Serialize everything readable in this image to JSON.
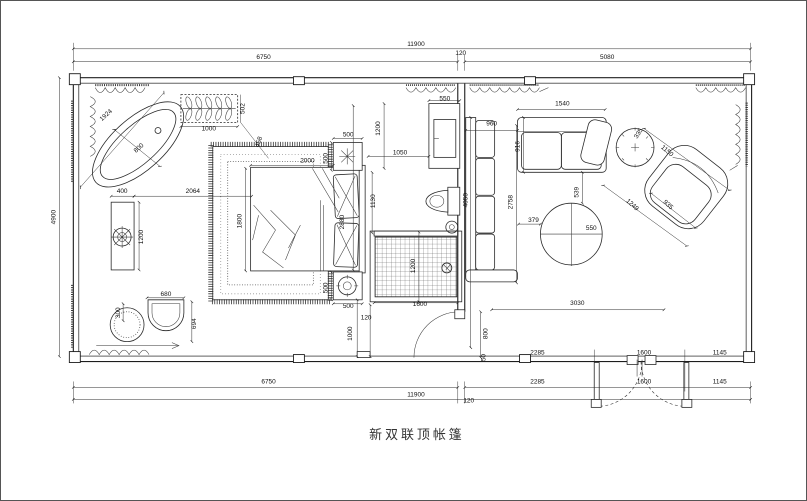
{
  "plan": {
    "title": "新双联顶帐篷",
    "overall": {
      "width_mm": "11900",
      "height_mm": "4900"
    },
    "dim_labels": [
      {
        "t": "11900",
        "x": 416,
        "y": 45
      },
      {
        "t": "6750",
        "x": 263,
        "y": 58
      },
      {
        "t": "120",
        "x": 461,
        "y": 54
      },
      {
        "t": "5080",
        "x": 608,
        "y": 58
      },
      {
        "t": "4900",
        "x": 54,
        "y": 217,
        "r": -90
      },
      {
        "t": "1924",
        "x": 106,
        "y": 116,
        "r": -42
      },
      {
        "t": "800",
        "x": 139,
        "y": 149,
        "r": -42
      },
      {
        "t": "1000",
        "x": 208,
        "y": 130
      },
      {
        "t": "502",
        "x": 244,
        "y": 108,
        "r": -90
      },
      {
        "t": "458",
        "x": 260,
        "y": 142,
        "r": -72
      },
      {
        "t": "400",
        "x": 121,
        "y": 193
      },
      {
        "t": "2064",
        "x": 192,
        "y": 193
      },
      {
        "t": "1200",
        "x": 142,
        "y": 237,
        "r": -90
      },
      {
        "t": "300",
        "x": 119,
        "y": 313,
        "r": -90
      },
      {
        "t": "680",
        "x": 165,
        "y": 296
      },
      {
        "t": "694",
        "x": 195,
        "y": 324,
        "r": -90
      },
      {
        "t": "2000",
        "x": 307,
        "y": 162
      },
      {
        "t": "1800",
        "x": 241,
        "y": 221,
        "r": -90
      },
      {
        "t": "500",
        "x": 348,
        "y": 136
      },
      {
        "t": "500",
        "x": 327,
        "y": 158,
        "r": -90
      },
      {
        "t": "500",
        "x": 327,
        "y": 288,
        "r": -90
      },
      {
        "t": "500",
        "x": 348,
        "y": 308
      },
      {
        "t": "550",
        "x": 445,
        "y": 100
      },
      {
        "t": "1200",
        "x": 380,
        "y": 128,
        "r": -90
      },
      {
        "t": "1050",
        "x": 400,
        "y": 154
      },
      {
        "t": "1130",
        "x": 375,
        "y": 201,
        "r": -90
      },
      {
        "t": "2880",
        "x": 344,
        "y": 222,
        "r": -90
      },
      {
        "t": "4050",
        "x": 468,
        "y": 200,
        "r": -90
      },
      {
        "t": "1000",
        "x": 352,
        "y": 334,
        "r": -90
      },
      {
        "t": "120",
        "x": 366,
        "y": 320
      },
      {
        "t": "1600",
        "x": 420,
        "y": 306
      },
      {
        "t": "1200",
        "x": 415,
        "y": 266,
        "r": -90
      },
      {
        "t": "800",
        "x": 488,
        "y": 334,
        "r": -90
      },
      {
        "t": "50",
        "x": 486,
        "y": 358,
        "r": -90
      },
      {
        "t": "960",
        "x": 492,
        "y": 125
      },
      {
        "t": "916",
        "x": 520,
        "y": 146,
        "r": -90
      },
      {
        "t": "1540",
        "x": 563,
        "y": 105
      },
      {
        "t": "335",
        "x": 641,
        "y": 134,
        "r": -58
      },
      {
        "t": "1150",
        "x": 667,
        "y": 152,
        "r": 40
      },
      {
        "t": "1249",
        "x": 632,
        "y": 206,
        "r": 42
      },
      {
        "t": "935",
        "x": 668,
        "y": 206,
        "r": 42
      },
      {
        "t": "539",
        "x": 579,
        "y": 192,
        "r": -90
      },
      {
        "t": "379",
        "x": 534,
        "y": 222
      },
      {
        "t": "550",
        "x": 592,
        "y": 230
      },
      {
        "t": "2758",
        "x": 513,
        "y": 202,
        "r": -90
      },
      {
        "t": "3030",
        "x": 578,
        "y": 305
      },
      {
        "t": "2285",
        "x": 538,
        "y": 355
      },
      {
        "t": "1600",
        "x": 645,
        "y": 355
      },
      {
        "t": "1145",
        "x": 721,
        "y": 355
      },
      {
        "t": "6750",
        "x": 268,
        "y": 384
      },
      {
        "t": "2285",
        "x": 538,
        "y": 384
      },
      {
        "t": "1600",
        "x": 645,
        "y": 384
      },
      {
        "t": "1145",
        "x": 721,
        "y": 384
      },
      {
        "t": "11900",
        "x": 416,
        "y": 397
      },
      {
        "t": "120",
        "x": 469,
        "y": 403
      }
    ]
  }
}
